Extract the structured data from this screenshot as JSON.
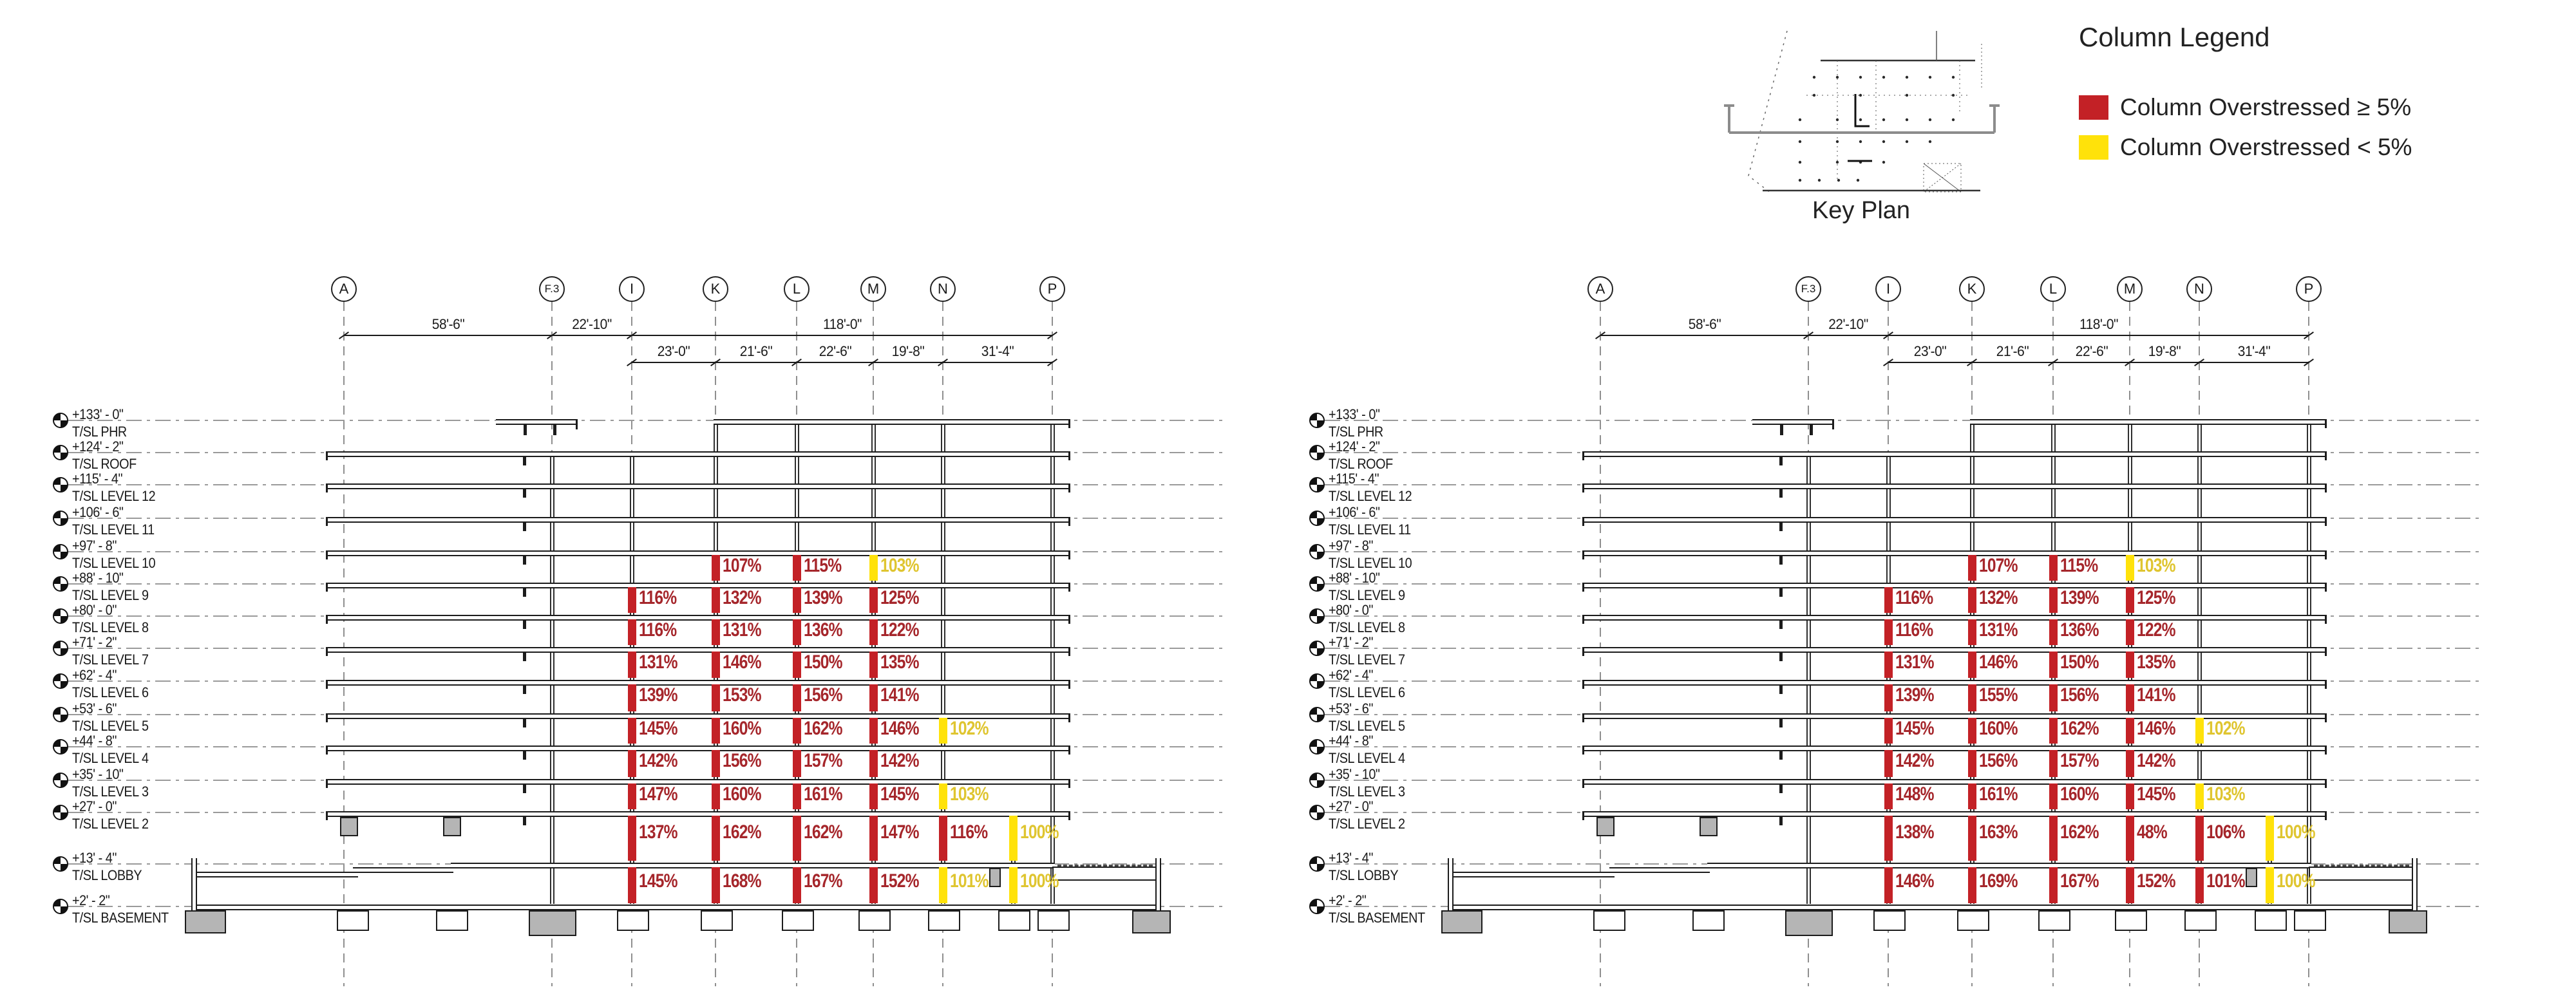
{
  "legend": {
    "title": "Column Legend",
    "items": [
      {
        "label": "Column Overstressed ≥ 5%",
        "status": "major",
        "color": "#C32126"
      },
      {
        "label": "Column Overstressed < 5%",
        "status": "minor",
        "color": "#FFE20A"
      }
    ]
  },
  "key_plan": {
    "label": "Key Plan"
  },
  "grids": [
    "A",
    "F.3",
    "I",
    "K",
    "L",
    "M",
    "N",
    "P"
  ],
  "dimensions": {
    "row1": [
      {
        "from": "A",
        "to": "F.3",
        "label": "58'-6\""
      },
      {
        "from": "F.3",
        "to": "I",
        "label": "22'-10\""
      },
      {
        "from": "I",
        "to": "P",
        "label": "118'-0\""
      }
    ],
    "row2": [
      {
        "from": "I",
        "to": "K",
        "label": "23'-0\""
      },
      {
        "from": "K",
        "to": "L",
        "label": "21'-6\""
      },
      {
        "from": "L",
        "to": "M",
        "label": "22'-6\""
      },
      {
        "from": "M",
        "to": "N",
        "label": "19'-8\""
      },
      {
        "from": "N",
        "to": "P",
        "label": "31'-4\""
      }
    ]
  },
  "levels": [
    {
      "elevation": "+133' - 0\"",
      "name": "T/SL PHR"
    },
    {
      "elevation": "+124' - 2\"",
      "name": "T/SL ROOF"
    },
    {
      "elevation": "+115' - 4\"",
      "name": "T/SL LEVEL 12"
    },
    {
      "elevation": "+106' - 6\"",
      "name": "T/SL LEVEL 11"
    },
    {
      "elevation": "+97' - 8\"",
      "name": "T/SL LEVEL 10"
    },
    {
      "elevation": "+88' - 10\"",
      "name": "T/SL LEVEL 9"
    },
    {
      "elevation": "+80' - 0\"",
      "name": "T/SL LEVEL 8"
    },
    {
      "elevation": "+71' - 2\"",
      "name": "T/SL LEVEL 7"
    },
    {
      "elevation": "+62' - 4\"",
      "name": "T/SL LEVEL 6"
    },
    {
      "elevation": "+53' - 6\"",
      "name": "T/SL LEVEL 5"
    },
    {
      "elevation": "+44' - 8\"",
      "name": "T/SL LEVEL 4"
    },
    {
      "elevation": "+35' - 10\"",
      "name": "T/SL LEVEL 3"
    },
    {
      "elevation": "+27' - 0\"",
      "name": "T/SL LEVEL 2"
    },
    {
      "elevation": "+13' - 4\"",
      "name": "T/SL LOBBY"
    },
    {
      "elevation": "+2' - 2\"",
      "name": "T/SL BASEMENT"
    }
  ],
  "elevations": [
    {
      "id": "left",
      "rows": [
        [
          {
            "grid": "K",
            "value": "107%",
            "status": "major"
          },
          {
            "grid": "L",
            "value": "115%",
            "status": "major"
          },
          {
            "grid": "M",
            "value": "103%",
            "status": "minor"
          }
        ],
        [
          {
            "grid": "I",
            "value": "116%",
            "status": "major"
          },
          {
            "grid": "K",
            "value": "132%",
            "status": "major"
          },
          {
            "grid": "L",
            "value": "139%",
            "status": "major"
          },
          {
            "grid": "M",
            "value": "125%",
            "status": "major"
          }
        ],
        [
          {
            "grid": "I",
            "value": "116%",
            "status": "major"
          },
          {
            "grid": "K",
            "value": "131%",
            "status": "major"
          },
          {
            "grid": "L",
            "value": "136%",
            "status": "major"
          },
          {
            "grid": "M",
            "value": "122%",
            "status": "major"
          }
        ],
        [
          {
            "grid": "I",
            "value": "131%",
            "status": "major"
          },
          {
            "grid": "K",
            "value": "146%",
            "status": "major"
          },
          {
            "grid": "L",
            "value": "150%",
            "status": "major"
          },
          {
            "grid": "M",
            "value": "135%",
            "status": "major"
          }
        ],
        [
          {
            "grid": "I",
            "value": "139%",
            "status": "major"
          },
          {
            "grid": "K",
            "value": "153%",
            "status": "major"
          },
          {
            "grid": "L",
            "value": "156%",
            "status": "major"
          },
          {
            "grid": "M",
            "value": "141%",
            "status": "major"
          }
        ],
        [
          {
            "grid": "I",
            "value": "145%",
            "status": "major"
          },
          {
            "grid": "K",
            "value": "160%",
            "status": "major"
          },
          {
            "grid": "L",
            "value": "162%",
            "status": "major"
          },
          {
            "grid": "M",
            "value": "146%",
            "status": "major"
          },
          {
            "grid": "N",
            "value": "102%",
            "status": "minor"
          }
        ],
        [
          {
            "grid": "I",
            "value": "142%",
            "status": "major"
          },
          {
            "grid": "K",
            "value": "156%",
            "status": "major"
          },
          {
            "grid": "L",
            "value": "157%",
            "status": "major"
          },
          {
            "grid": "M",
            "value": "142%",
            "status": "major"
          }
        ],
        [
          {
            "grid": "I",
            "value": "147%",
            "status": "major"
          },
          {
            "grid": "K",
            "value": "160%",
            "status": "major"
          },
          {
            "grid": "L",
            "value": "161%",
            "status": "major"
          },
          {
            "grid": "M",
            "value": "145%",
            "status": "major"
          },
          {
            "grid": "N",
            "value": "103%",
            "status": "minor"
          }
        ],
        [
          {
            "grid": "I",
            "value": "137%",
            "status": "major"
          },
          {
            "grid": "K",
            "value": "162%",
            "status": "major"
          },
          {
            "grid": "L",
            "value": "162%",
            "status": "major"
          },
          {
            "grid": "M",
            "value": "147%",
            "status": "major"
          },
          {
            "grid": "N",
            "value": "116%",
            "status": "major"
          },
          {
            "grid": "P*",
            "value": "100%",
            "status": "minor"
          }
        ],
        [
          {
            "grid": "I",
            "value": "145%",
            "status": "major"
          },
          {
            "grid": "K",
            "value": "168%",
            "status": "major"
          },
          {
            "grid": "L",
            "value": "167%",
            "status": "major"
          },
          {
            "grid": "M",
            "value": "152%",
            "status": "major"
          },
          {
            "grid": "N",
            "value": "101%",
            "status": "minor"
          },
          {
            "grid": "P*",
            "value": "100%",
            "status": "minor"
          }
        ]
      ]
    },
    {
      "id": "right",
      "rows": [
        [
          {
            "grid": "K",
            "value": "107%",
            "status": "major"
          },
          {
            "grid": "L",
            "value": "115%",
            "status": "major"
          },
          {
            "grid": "M",
            "value": "103%",
            "status": "minor"
          }
        ],
        [
          {
            "grid": "I",
            "value": "116%",
            "status": "major"
          },
          {
            "grid": "K",
            "value": "132%",
            "status": "major"
          },
          {
            "grid": "L",
            "value": "139%",
            "status": "major"
          },
          {
            "grid": "M",
            "value": "125%",
            "status": "major"
          }
        ],
        [
          {
            "grid": "I",
            "value": "116%",
            "status": "major"
          },
          {
            "grid": "K",
            "value": "131%",
            "status": "major"
          },
          {
            "grid": "L",
            "value": "136%",
            "status": "major"
          },
          {
            "grid": "M",
            "value": "122%",
            "status": "major"
          }
        ],
        [
          {
            "grid": "I",
            "value": "131%",
            "status": "major"
          },
          {
            "grid": "K",
            "value": "146%",
            "status": "major"
          },
          {
            "grid": "L",
            "value": "150%",
            "status": "major"
          },
          {
            "grid": "M",
            "value": "135%",
            "status": "major"
          }
        ],
        [
          {
            "grid": "I",
            "value": "139%",
            "status": "major"
          },
          {
            "grid": "K",
            "value": "155%",
            "status": "major"
          },
          {
            "grid": "L",
            "value": "156%",
            "status": "major"
          },
          {
            "grid": "M",
            "value": "141%",
            "status": "major"
          }
        ],
        [
          {
            "grid": "I",
            "value": "145%",
            "status": "major"
          },
          {
            "grid": "K",
            "value": "160%",
            "status": "major"
          },
          {
            "grid": "L",
            "value": "162%",
            "status": "major"
          },
          {
            "grid": "M",
            "value": "146%",
            "status": "major"
          },
          {
            "grid": "N",
            "value": "102%",
            "status": "minor"
          }
        ],
        [
          {
            "grid": "I",
            "value": "142%",
            "status": "major"
          },
          {
            "grid": "K",
            "value": "156%",
            "status": "major"
          },
          {
            "grid": "L",
            "value": "157%",
            "status": "major"
          },
          {
            "grid": "M",
            "value": "142%",
            "status": "major"
          }
        ],
        [
          {
            "grid": "I",
            "value": "148%",
            "status": "major"
          },
          {
            "grid": "K",
            "value": "161%",
            "status": "major"
          },
          {
            "grid": "L",
            "value": "160%",
            "status": "major"
          },
          {
            "grid": "M",
            "value": "145%",
            "status": "major"
          },
          {
            "grid": "N",
            "value": "103%",
            "status": "minor"
          }
        ],
        [
          {
            "grid": "I",
            "value": "138%",
            "status": "major"
          },
          {
            "grid": "K",
            "value": "163%",
            "status": "major"
          },
          {
            "grid": "L",
            "value": "162%",
            "status": "major"
          },
          {
            "grid": "M",
            "value": "48%",
            "status": "major"
          },
          {
            "grid": "N",
            "value": "106%",
            "status": "major"
          },
          {
            "grid": "P*",
            "value": "100%",
            "status": "minor"
          }
        ],
        [
          {
            "grid": "I",
            "value": "146%",
            "status": "major"
          },
          {
            "grid": "K",
            "value": "169%",
            "status": "major"
          },
          {
            "grid": "L",
            "value": "167%",
            "status": "major"
          },
          {
            "grid": "M",
            "value": "152%",
            "status": "major"
          },
          {
            "grid": "N",
            "value": "101%",
            "status": "major"
          },
          {
            "grid": "P*",
            "value": "100%",
            "status": "minor"
          }
        ]
      ]
    }
  ],
  "colors": {
    "bar_major": "#C32126",
    "bar_minor": "#FFE20A",
    "text_major": "#A5262B",
    "text_minor": "#DFC530"
  }
}
